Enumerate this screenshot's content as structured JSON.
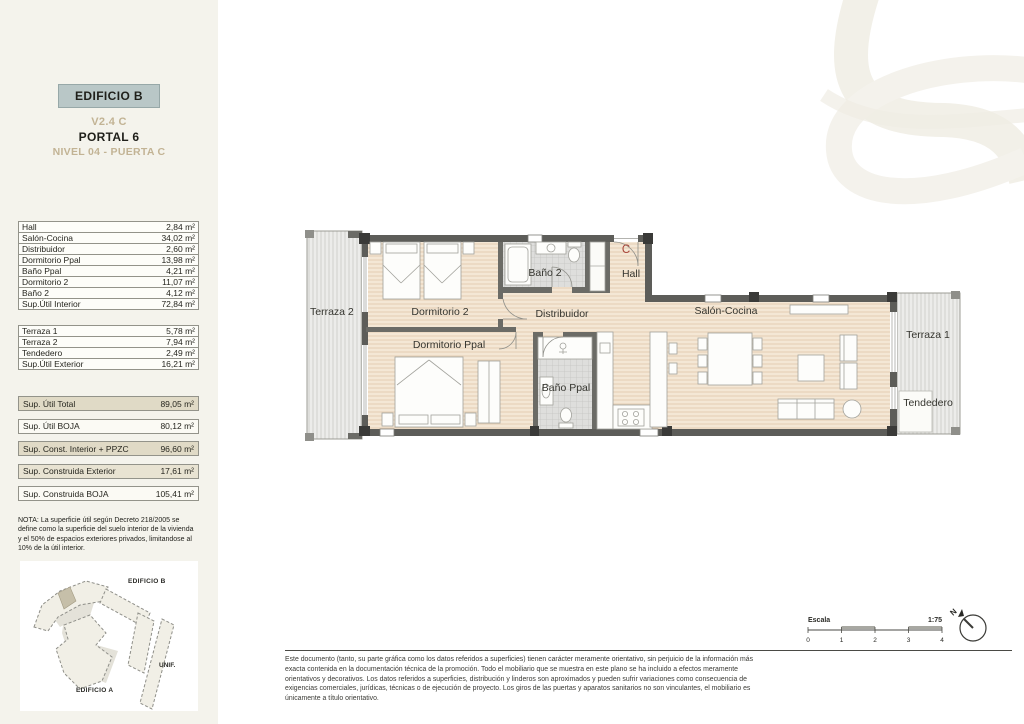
{
  "header": {
    "building": "EDIFICIO B",
    "unit": "V2.4 C",
    "portal": "PORTAL 6",
    "level": "NIVEL 04 - PUERTA C"
  },
  "areas": {
    "interior_rows": [
      {
        "label": "Hall",
        "value": "2,84 m²"
      },
      {
        "label": "Salón-Cocina",
        "value": "34,02 m²"
      },
      {
        "label": "Distribuidor",
        "value": "2,60 m²"
      },
      {
        "label": "Dormitorio Ppal",
        "value": "13,98 m²"
      },
      {
        "label": "Baño Ppal",
        "value": "4,21 m²"
      },
      {
        "label": "Dormitorio 2",
        "value": "11,07 m²"
      },
      {
        "label": "Baño 2",
        "value": "4,12 m²"
      },
      {
        "label": "Sup.Útil Interior",
        "value": "72,84 m²"
      }
    ],
    "exterior_rows": [
      {
        "label": "Terraza 1",
        "value": "5,78 m²"
      },
      {
        "label": "Terraza 2",
        "value": "7,94 m²"
      },
      {
        "label": "Tendedero",
        "value": "2,49 m²"
      },
      {
        "label": "Sup.Útil Exterior",
        "value": "16,21 m²"
      }
    ],
    "summary_rows": [
      {
        "label": "Sup. Útil Total",
        "value": "89,05 m²"
      },
      {
        "label": "Sup. Útil BOJA",
        "value": "80,12 m²"
      },
      {
        "label": "Sup. Const. Interior + PPZC",
        "value": "96,60 m²"
      },
      {
        "label": "Sup. Construida Exterior",
        "value": "17,61 m²"
      },
      {
        "label": "Sup. Construida BOJA",
        "value": "105,41 m²"
      }
    ]
  },
  "nota": "NOTA: La superficie útil según Decreto 218/2005 se define como la superficie del suelo interior de la vivienda y el 50% de espacios exteriores privados, limitandose al 10% de la útil interior.",
  "site_plan": {
    "edificio_b": "EDIFICIO B",
    "unif": "UNIF.",
    "edificio_a": "EDIFICIO A"
  },
  "plan_rooms": {
    "terraza2": "Terraza 2",
    "dormitorio2": "Dormitorio 2",
    "dormitorio_ppal": "Dormitorio Ppal",
    "bano2": "Baño 2",
    "bano_ppal": "Baño Ppal",
    "distribuidor": "Distribuidor",
    "hall": "Hall",
    "salon": "Salón-Cocina",
    "terraza1": "Terraza 1",
    "tendedero": "Tendedero",
    "door_letter": "C"
  },
  "scale": {
    "label": "Escala",
    "ratio": "1:75",
    "ticks": [
      "0",
      "1",
      "2",
      "3",
      "4"
    ],
    "north": "N"
  },
  "disclaimer": "Este documento (tanto, su parte gráfica como los datos referidos a superficies) tienen carácter meramente orientativo, sin perjuicio de la información más exacta contenida en la documentación técnica de la promoción. Todo el mobiliario que se muestra en este plano se ha incluido a efectos meramente orientativos y decorativos. Los datos referidos a superficies, distribución y linderos son aproximados y pueden sufrir variaciones como consecuencia de exigencias comerciales, jurídicas, técnicas o de ejecución de proyecto. Los giros de las puertas y aparatos sanitarios no son vinculantes, el mobiliario es únicamente a título orientativo.",
  "colors": {
    "accent_box": "#b9c7c7",
    "gold": "#c2b394",
    "wall": "#5d5d59",
    "floor": "#f4e7d5",
    "beige_row": "#e0dac6",
    "door_letter": "#a84338"
  }
}
